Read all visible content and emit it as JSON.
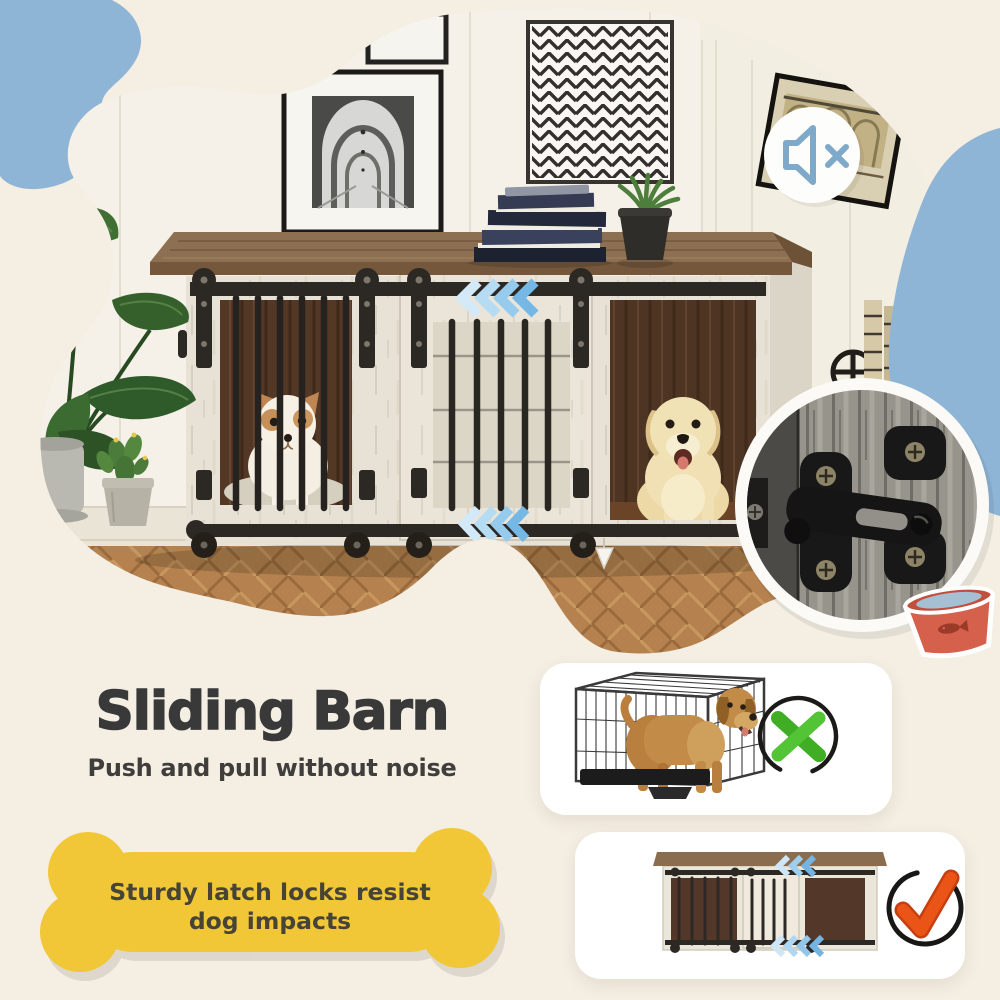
{
  "headline": {
    "title": "Sliding Barn",
    "subtitle": "Push and pull without noise"
  },
  "callout": {
    "text": "Sturdy latch locks resist dog impacts"
  },
  "media": {
    "mute_icon": "speaker-muted",
    "slide_direction_icon": "triple-chevron-left"
  },
  "comparison": {
    "wire_crate_verdict_icon": "green-cross",
    "barn_crate_verdict_icon": "orange-check"
  },
  "colors": {
    "background": "#f4eee3",
    "accent_blue_blob": "#8fb5d6",
    "chevron_blue": "#76b8e5",
    "bone_yellow": "#f1c737",
    "title_text": "#393939",
    "reject_green": "#43b027",
    "approve_orange": "#e8501c",
    "bowl_red": "#d5604c",
    "crate_wood_top": "#8d6f51",
    "crate_whitewash": "#e7e2d5",
    "crate_interior_wood": "#533826"
  }
}
